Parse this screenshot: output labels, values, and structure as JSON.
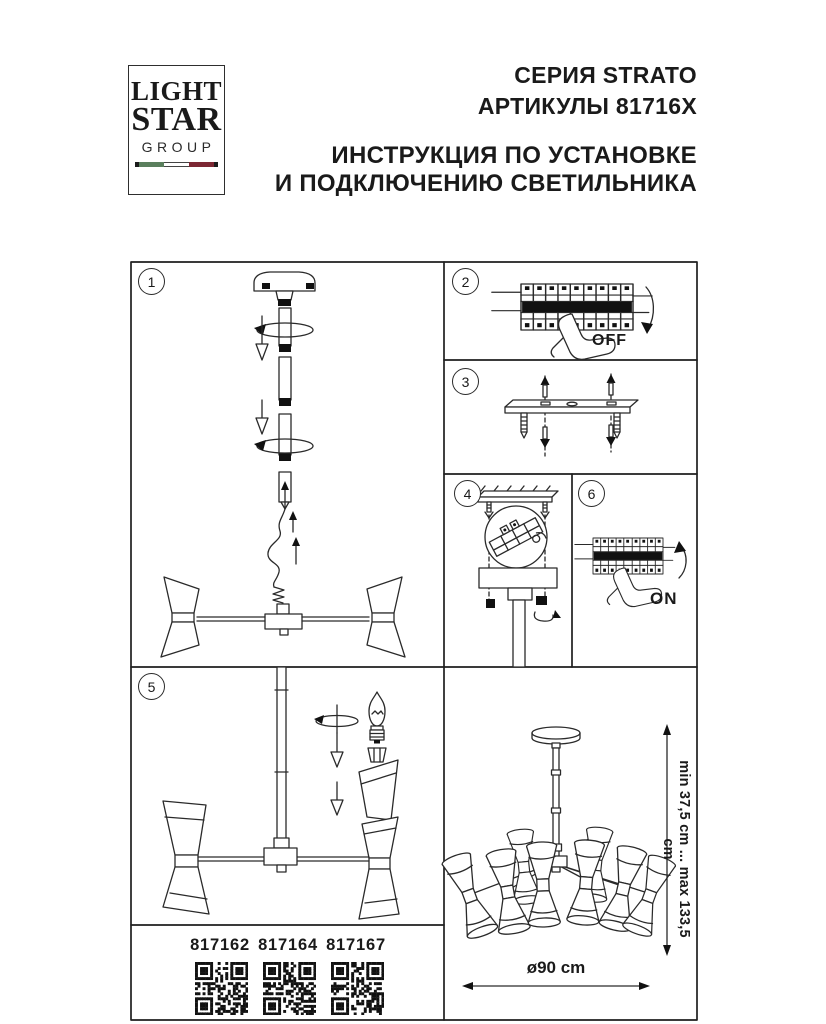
{
  "logo": {
    "line1": "LIGHT",
    "line2": "STAR",
    "line3": "GROUP",
    "flag_green": "#5a7f5d",
    "flag_white": "#ffffff",
    "flag_red": "#7c2733",
    "flag_cap": "#1c1c1c"
  },
  "header": {
    "series": "СЕРИЯ STRATO",
    "articles": "АРТИКУЛЫ 81716X",
    "title_line1": "ИНСТРУКЦИЯ ПО УСТАНОВКЕ",
    "title_line2": "И ПОДКЛЮЧЕНИЮ СВЕТИЛЬНИКА"
  },
  "steps": {
    "s1": "1",
    "s2": "2",
    "s3": "3",
    "s4": "4",
    "s5": "5",
    "s6": "6"
  },
  "labels": {
    "off": "OFF",
    "on": "ON"
  },
  "articles": [
    "817162",
    "817164",
    "817167"
  ],
  "dimensions": {
    "height_range": "min 37,5 cm ... max 133,5 cm",
    "diameter": "ø90 cm"
  },
  "colors": {
    "line": "#2a2a2a",
    "text": "#1a1a1a"
  }
}
